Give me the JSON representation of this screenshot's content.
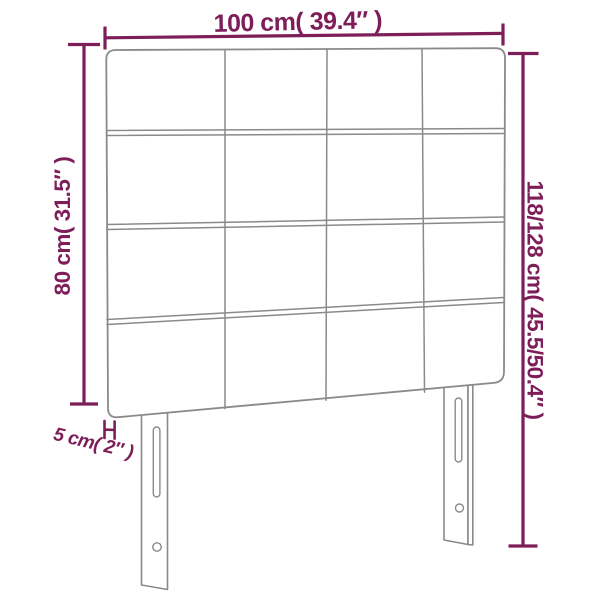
{
  "diagram": {
    "product": "upholstered-headboard-dimension-diagram",
    "labels": {
      "width": "100 cm( 39.4″ )",
      "panel_height": "80 cm( 31.5″ )",
      "total_height": "118/128 cm( 45.5/50.4″ )",
      "depth": "5 cm( 2″ )"
    },
    "colors": {
      "dimension_accent": "#7d1e59",
      "outline": "#8a8a8a",
      "background": "#ffffff"
    },
    "headboard": {
      "grid_rows": 4,
      "grid_columns": 4,
      "legs": 2
    }
  }
}
